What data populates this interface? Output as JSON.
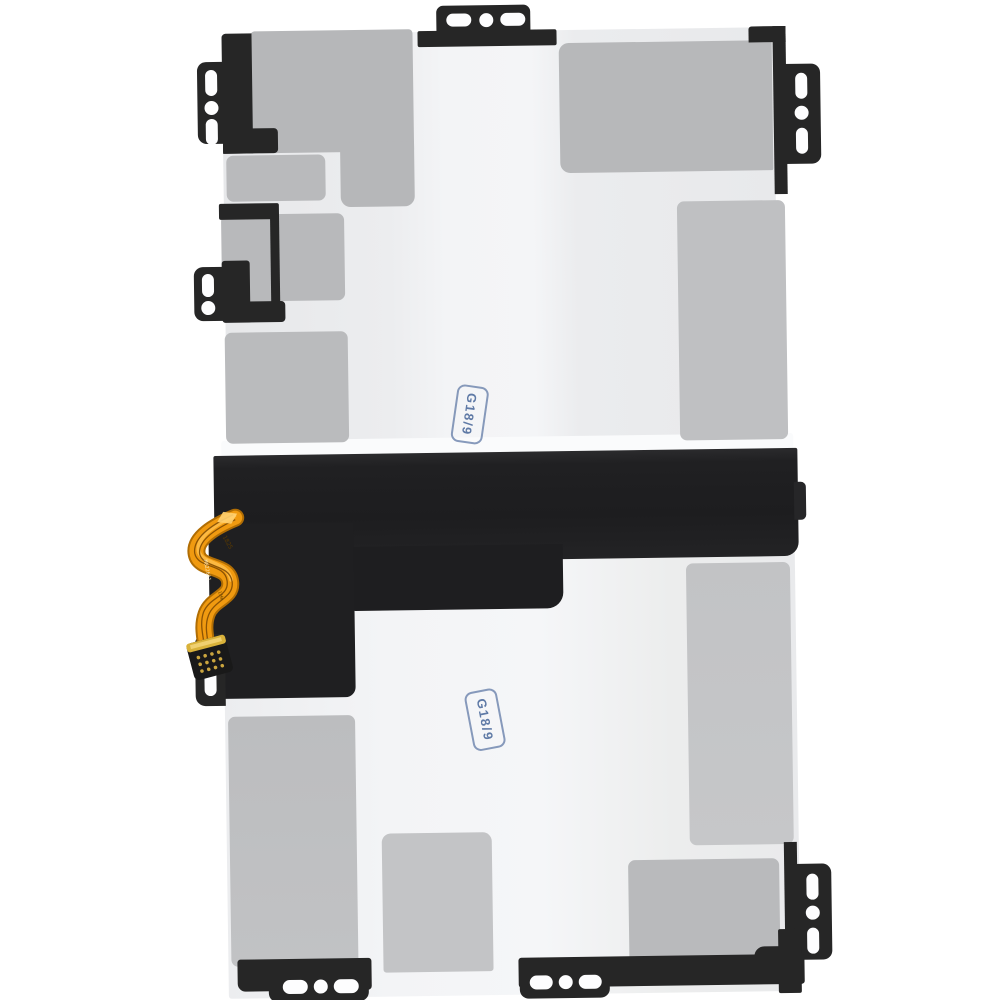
{
  "image": {
    "description": "Replacement tablet battery pack, top view: two light cells with gray adhesive pads, black mounting frame with screw tabs, middle black spacer band, orange flex cable with connector, blue QC ink stamps",
    "background_color": "#ffffff"
  },
  "stamps": {
    "upper": {
      "label": "G18/9"
    },
    "lower": {
      "label": "G18/9"
    }
  },
  "flex_cable": {
    "marking_top": "1825",
    "marking_mid": "M8226A1",
    "marking_small": "LH⊕",
    "color": "#f09a10"
  },
  "colors": {
    "frame_black": "#262626",
    "band_black": "#202022",
    "adhesive_gray": "#b8b9bb",
    "cell_white": "#f0f1f3",
    "stamp_blue": "#5f7aa6",
    "flex_orange": "#f09a10",
    "connector_gold": "#d9b23a"
  }
}
